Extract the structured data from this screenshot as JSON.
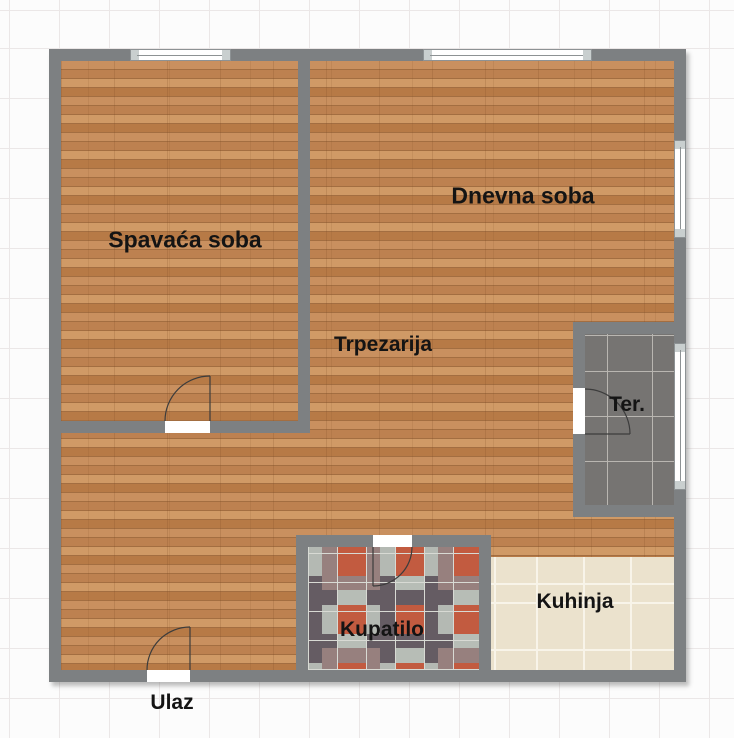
{
  "rooms": [
    {
      "id": "spavaca-soba",
      "label": "Spavaća soba"
    },
    {
      "id": "dnevna-soba",
      "label": "Dnevna soba"
    },
    {
      "id": "trpezarija",
      "label": "Trpezarija"
    },
    {
      "id": "terasa",
      "label": "Ter."
    },
    {
      "id": "kuhinja",
      "label": "Kuhinja"
    },
    {
      "id": "kupatilo",
      "label": "Kupatilo"
    },
    {
      "id": "ulaz",
      "label": "Ulaz"
    }
  ],
  "colors": {
    "background": "#fcfcfc",
    "grid_line": "#ebe7e7",
    "wall": "#7d8082",
    "label_text": "#141414",
    "door_line": "#3c3c3c",
    "window_glass": "#ffffff",
    "window_frame": "#8d9294",
    "window_cap": "#c9cfcf",
    "wood_base": "#c58a57",
    "wood_dark": "#b17742",
    "wood_light": "#d39d6b",
    "terrace_tile": "#767472",
    "terrace_grout": "#b9b6b1",
    "kitchen_tile": "#ebe2cd",
    "kitchen_grout": "#f8f4e9",
    "bath_sage": "#b7bdb6",
    "bath_slate": "#8f9a95",
    "bath_plum": "#655c63",
    "bath_rust": "#c25b40",
    "bath_mauve": "#97807e",
    "bath_grout": "#d8dad4"
  }
}
